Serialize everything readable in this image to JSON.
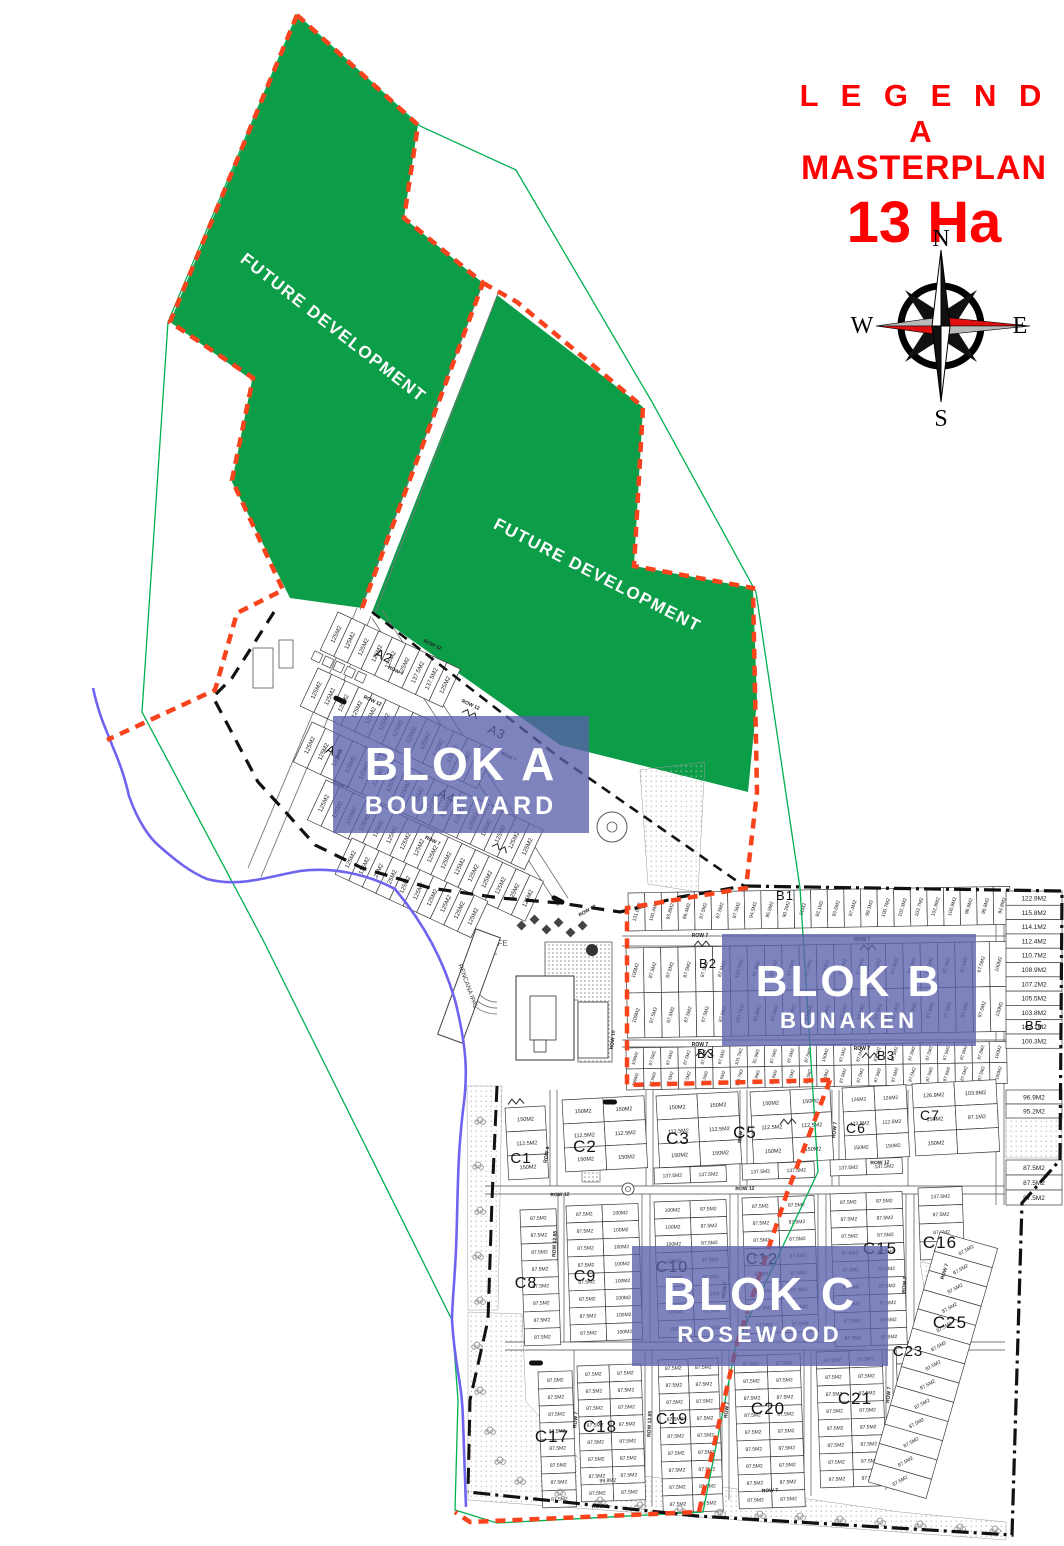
{
  "legend": {
    "line1": "L E G E N D A",
    "line2": "MASTERPLAN",
    "line3": "13 Ha"
  },
  "compass": {
    "north": "N",
    "east": "E",
    "south": "S",
    "west": "W"
  },
  "future": {
    "label": "FUTURE DEVELOPMENT"
  },
  "blocks": [
    {
      "id": "A",
      "title": "BLOK A",
      "subtitle": "BOULEVARD"
    },
    {
      "id": "B",
      "title": "BLOK B",
      "subtitle": "BUNAKEN"
    },
    {
      "id": "C",
      "title": "BLOK C",
      "subtitle": "ROSEWOOD"
    }
  ],
  "poi": {
    "cafe": "CAFE",
    "ipal": "RENCANA IPAL"
  },
  "colors": {
    "accent_red": "#fe0000",
    "green_area": "#0c9d49",
    "green_line": "#00b050",
    "orange_boundary": "#f8431c",
    "purple_overlay": "#5a60ab",
    "river_blue": "#6f63ef"
  },
  "lot_grids": [
    {
      "id": "A2",
      "x": 338,
      "y": 612,
      "rot": 25,
      "cols": 9,
      "rows": 1,
      "cw": 15,
      "ch": 42,
      "fs": 6,
      "lrot": -90,
      "labels_cols": [
        "125M2",
        "125M2",
        "125M2",
        "125M2",
        "125M2",
        "125M2",
        "137.5M2",
        "137.5M2",
        "125M2"
      ]
    },
    {
      "id": "A1a",
      "x": 318,
      "y": 668,
      "rot": 25,
      "cols": 13,
      "rows": 1,
      "cw": 15,
      "ch": 42,
      "fs": 6,
      "lrot": -90,
      "label": "125M2"
    },
    {
      "id": "A1b",
      "x": 312,
      "y": 722,
      "rot": 25,
      "cols": 17,
      "rows": 1,
      "cw": 15,
      "ch": 44,
      "fs": 6,
      "lrot": -90,
      "label": "125M2"
    },
    {
      "id": "A4",
      "x": 326,
      "y": 780,
      "rot": 25,
      "cols": 16,
      "rows": 1,
      "cw": 15,
      "ch": 44,
      "fs": 6,
      "lrot": -90,
      "label": "125M2"
    },
    {
      "id": "A5",
      "x": 352,
      "y": 838,
      "rot": 25,
      "cols": 10,
      "rows": 1,
      "cw": 15,
      "ch": 40,
      "fs": 6,
      "lrot": -90,
      "label": "125M2"
    },
    {
      "id": "B1",
      "x": 628,
      "y": 893,
      "rot": -1,
      "cols": 23,
      "rows": 1,
      "cw": 16.6,
      "ch": 38,
      "fs": 5,
      "lrot": -72,
      "labels_cols": [
        "131.6M2",
        "100.4M2",
        "93.8M2",
        "89.4M2",
        "87.5M2",
        "87.5M2",
        "87.5M2",
        "94.5M2",
        "95.5M2",
        "90.2M2",
        "92M2",
        "93.1M2",
        "93.6M2",
        "97.4M2",
        "99.1M2",
        "100.7M2",
        "102.3M2",
        "103.7M2",
        "102.8M2",
        "100.8M2",
        "98.8M2",
        "96.8M2",
        "94.8M2"
      ]
    },
    {
      "id": "B2",
      "x": 626,
      "y": 948,
      "rot": -1,
      "cols": 22,
      "rows": 2,
      "cw": 17.3,
      "ch": 45,
      "fs": 5,
      "lrot": -72,
      "labels_cols": [
        "100M2",
        "87.5M2",
        "87.5M2",
        "87.5M2",
        "87.5M2",
        "87.5M2",
        "103.7M2",
        "92.9M2",
        "87.5M2",
        "87.5M2",
        "87.5M2",
        "100M2",
        "87.5M2",
        "87.5M2",
        "87.5M2",
        "87.5M2",
        "87.5M2",
        "87.5M2",
        "87.5M2",
        "87.5M2",
        "87.5M2",
        "100M2"
      ]
    },
    {
      "id": "B3",
      "x": 626,
      "y": 1048,
      "rot": -1,
      "cols": 22,
      "rows": 2,
      "cw": 17.3,
      "ch": 21,
      "fs": 4.5,
      "lrot": -72,
      "labels_cols": [
        "100M2",
        "87.5M2",
        "87.5M2",
        "87.5M2",
        "87.5M2",
        "87.5M2",
        "103.7M2",
        "92.9M2",
        "87.5M2",
        "87.5M2",
        "87.5M2",
        "100M2",
        "87.5M2",
        "87.5M2",
        "87.5M2",
        "87.5M2",
        "87.5M2",
        "87.5M2",
        "87.5M2",
        "87.5M2",
        "87.5M2",
        "100M2"
      ]
    },
    {
      "id": "B-right",
      "x": 1006,
      "y": 891,
      "rot": 0,
      "cols": 1,
      "rows": 11,
      "cw": 56,
      "ch": 14.3,
      "fs": 6.5,
      "labels_rows": [
        "122.9M2",
        "115.8M2",
        "114.1M2",
        "112.4M2",
        "110.7M2",
        "108.9M2",
        "107.2M2",
        "105.5M2",
        "103.8M2",
        "102.1M2",
        "100.3M2"
      ]
    },
    {
      "id": "B-right2",
      "x": 1006,
      "y": 1090,
      "rot": 0,
      "cols": 1,
      "rows": 2,
      "cw": 56,
      "ch": 14,
      "fs": 6.5,
      "labels_rows": [
        "96.9M2",
        "95.2M2"
      ]
    },
    {
      "id": "B-right3",
      "x": 1006,
      "y": 1160,
      "rot": 0,
      "cols": 1,
      "rows": 3,
      "cw": 56,
      "ch": 15,
      "fs": 6.5,
      "label": "87.5M2"
    },
    {
      "id": "C1",
      "x": 505,
      "y": 1108,
      "rot": -3,
      "cols": 1,
      "rows": 3,
      "cw": 40,
      "ch": 24,
      "fs": 5.5,
      "labels_rows": [
        "150M2",
        "112.5M2",
        "150M2"
      ]
    },
    {
      "id": "C2",
      "x": 562,
      "y": 1100,
      "rot": -3,
      "cols": 2,
      "rows": 3,
      "cw": 41,
      "ch": 24,
      "fs": 5.5,
      "labels_rows": [
        "150M2",
        "112.5M2",
        "150M2"
      ]
    },
    {
      "id": "C3",
      "x": 656,
      "y": 1096,
      "rot": -3,
      "cols": 2,
      "rows": 3,
      "cw": 41,
      "ch": 24,
      "fs": 5.5,
      "labels_rows": [
        "150M2",
        "112.5M2",
        "150M2"
      ]
    },
    {
      "id": "C5",
      "x": 750,
      "y": 1092,
      "rot": -3,
      "cols": 2,
      "rows": 3,
      "cw": 40,
      "ch": 24,
      "fs": 5.5,
      "labels_rows": [
        "150M2",
        "112.5M2",
        "150M2"
      ]
    },
    {
      "id": "C6",
      "x": 842,
      "y": 1088,
      "rot": -3,
      "cols": 2,
      "rows": 3,
      "cw": 32,
      "ch": 24,
      "fs": 5,
      "labels_rows": [
        "126M2",
        "112.5M2",
        "150M2"
      ]
    },
    {
      "id": "C7",
      "x": 912,
      "y": 1084,
      "rot": -3,
      "cols": 2,
      "rows": 3,
      "cw": 42,
      "ch": 24,
      "fs": 5.5,
      "labels_grid": [
        [
          "126.9M2",
          "103.9M2"
        ],
        [
          "150M2",
          "97.1M2"
        ],
        [
          "150M2",
          ""
        ]
      ]
    },
    {
      "id": "C8",
      "x": 520,
      "y": 1210,
      "rot": -2,
      "cols": 1,
      "rows": 8,
      "cw": 36,
      "ch": 17,
      "fs": 5,
      "label": "87.5M2"
    },
    {
      "id": "C9",
      "x": 566,
      "y": 1206,
      "rot": -2,
      "cols": 2,
      "rows": 8,
      "cw": 36,
      "ch": 17,
      "fs": 5,
      "labels_cols": [
        "87.5M2",
        "100M2"
      ]
    },
    {
      "id": "C10t",
      "x": 654,
      "y": 1168,
      "rot": -2,
      "cols": 2,
      "rows": 1,
      "cw": 36,
      "ch": 16,
      "fs": 5,
      "label": "137.5M2"
    },
    {
      "id": "C10",
      "x": 654,
      "y": 1202,
      "rot": -2,
      "cols": 2,
      "rows": 8,
      "cw": 36,
      "ch": 17,
      "fs": 5,
      "labels_cols": [
        "100M2",
        "87.5M2"
      ]
    },
    {
      "id": "C12t",
      "x": 742,
      "y": 1164,
      "rot": -2,
      "cols": 2,
      "rows": 1,
      "cw": 36,
      "ch": 16,
      "fs": 5,
      "label": "137.5M2"
    },
    {
      "id": "C12",
      "x": 742,
      "y": 1198,
      "rot": -2,
      "cols": 2,
      "rows": 8,
      "cw": 36,
      "ch": 17,
      "fs": 5,
      "label": "87.5M2"
    },
    {
      "id": "C15t",
      "x": 830,
      "y": 1160,
      "rot": -2,
      "cols": 2,
      "rows": 1,
      "cw": 36,
      "ch": 16,
      "fs": 5,
      "label": "137.5M2"
    },
    {
      "id": "C15",
      "x": 830,
      "y": 1194,
      "rot": -2,
      "cols": 2,
      "rows": 9,
      "cw": 36,
      "ch": 17,
      "fs": 5,
      "label": "87.5M2"
    },
    {
      "id": "C16",
      "x": 918,
      "y": 1188,
      "rot": -2,
      "cols": 1,
      "rows": 4,
      "cw": 44,
      "ch": 18,
      "fs": 5,
      "labels_rows": [
        "137.5M2",
        "87.5M2",
        "87.5M2",
        "87.5M2"
      ]
    },
    {
      "id": "C17",
      "x": 538,
      "y": 1372,
      "rot": -2,
      "cols": 1,
      "rows": 8,
      "cw": 34,
      "ch": 17,
      "fs": 5,
      "label": "87.5M2"
    },
    {
      "id": "C18",
      "x": 577,
      "y": 1366,
      "rot": -2,
      "cols": 2,
      "rows": 8,
      "cw": 32,
      "ch": 17,
      "fs": 5,
      "label": "87.5M2"
    },
    {
      "id": "C19",
      "x": 658,
      "y": 1360,
      "rot": -2,
      "cols": 2,
      "rows": 9,
      "cw": 30,
      "ch": 17,
      "fs": 5,
      "label": "87.5M2"
    },
    {
      "id": "C20",
      "x": 734,
      "y": 1356,
      "rot": -2,
      "cols": 2,
      "rows": 9,
      "cw": 33,
      "ch": 17,
      "fs": 5,
      "label": "87.5M2"
    },
    {
      "id": "C21",
      "x": 816,
      "y": 1352,
      "rot": -2,
      "cols": 2,
      "rows": 8,
      "cw": 33,
      "ch": 17,
      "fs": 5,
      "label": "87.5M2"
    },
    {
      "id": "C23",
      "x": 896,
      "y": 1348,
      "rot": -2,
      "cols": 1,
      "rows": 4,
      "cw": 34,
      "ch": 16,
      "fs": 5,
      "label": "87.5M2"
    },
    {
      "id": "C25",
      "x": 940,
      "y": 1232,
      "rot": 16,
      "cols": 1,
      "rows": 13,
      "cw": 60,
      "ch": 20,
      "fs": 5,
      "lrot": -45,
      "label": "87.5M2"
    }
  ],
  "section_labels": [
    {
      "t": "A1",
      "x": 333,
      "y": 756,
      "rot": 25,
      "fs": 13
    },
    {
      "t": "A2",
      "x": 382,
      "y": 660,
      "rot": 25,
      "fs": 13
    },
    {
      "t": "A3",
      "x": 495,
      "y": 736,
      "rot": 25,
      "fs": 13
    },
    {
      "t": "A4",
      "x": 445,
      "y": 800,
      "rot": 25,
      "fs": 13
    },
    {
      "t": "B1",
      "x": 785,
      "y": 900,
      "rot": 0,
      "fs": 13
    },
    {
      "t": "B2",
      "x": 708,
      "y": 968,
      "rot": 0,
      "fs": 13
    },
    {
      "t": "B3",
      "x": 706,
      "y": 1058,
      "rot": 0,
      "fs": 13
    },
    {
      "t": "B3",
      "x": 886,
      "y": 1060,
      "rot": 0,
      "fs": 13
    },
    {
      "t": "B5",
      "x": 1034,
      "y": 1030,
      "rot": 0,
      "fs": 13
    },
    {
      "t": "C1",
      "x": 521,
      "y": 1163,
      "rot": 0,
      "fs": 15
    },
    {
      "t": "C2",
      "x": 585,
      "y": 1152,
      "rot": 0,
      "fs": 17
    },
    {
      "t": "C3",
      "x": 678,
      "y": 1144,
      "rot": 0,
      "fs": 17
    },
    {
      "t": "C5",
      "x": 745,
      "y": 1138,
      "rot": 0,
      "fs": 17
    },
    {
      "t": "C6",
      "x": 856,
      "y": 1133,
      "rot": 0,
      "fs": 14
    },
    {
      "t": "C7",
      "x": 930,
      "y": 1120,
      "rot": 0,
      "fs": 14
    },
    {
      "t": "C8",
      "x": 526,
      "y": 1288,
      "rot": 0,
      "fs": 16
    },
    {
      "t": "C9",
      "x": 585,
      "y": 1281,
      "rot": 0,
      "fs": 16
    },
    {
      "t": "C10",
      "x": 672,
      "y": 1272,
      "rot": 0,
      "fs": 16
    },
    {
      "t": "C12",
      "x": 762,
      "y": 1264,
      "rot": 0,
      "fs": 16
    },
    {
      "t": "C15",
      "x": 880,
      "y": 1254,
      "rot": 0,
      "fs": 17
    },
    {
      "t": "C16",
      "x": 940,
      "y": 1248,
      "rot": 0,
      "fs": 17
    },
    {
      "t": "C17",
      "x": 552,
      "y": 1442,
      "rot": 0,
      "fs": 17
    },
    {
      "t": "C18",
      "x": 600,
      "y": 1432,
      "rot": 0,
      "fs": 17
    },
    {
      "t": "C19",
      "x": 672,
      "y": 1424,
      "rot": 0,
      "fs": 16
    },
    {
      "t": "C20",
      "x": 768,
      "y": 1414,
      "rot": 0,
      "fs": 17
    },
    {
      "t": "C21",
      "x": 855,
      "y": 1404,
      "rot": 0,
      "fs": 17
    },
    {
      "t": "C23",
      "x": 908,
      "y": 1356,
      "rot": 0,
      "fs": 15
    },
    {
      "t": "C25",
      "x": 950,
      "y": 1328,
      "rot": 0,
      "fs": 17
    }
  ],
  "row_labels": [
    {
      "t": "ROW 12",
      "x": 372,
      "y": 702,
      "rot": 25
    },
    {
      "t": "ROW 7",
      "x": 340,
      "y": 786,
      "rot": 25
    },
    {
      "t": "ROW 7",
      "x": 432,
      "y": 842,
      "rot": 25
    },
    {
      "t": "ROW 12",
      "x": 470,
      "y": 706,
      "rot": 25
    },
    {
      "t": "ROW 7",
      "x": 508,
      "y": 758,
      "rot": 25
    },
    {
      "t": "ROW 12",
      "x": 432,
      "y": 646,
      "rot": 25
    },
    {
      "t": "ROW 7",
      "x": 395,
      "y": 672,
      "rot": 25
    },
    {
      "t": "ROW 7",
      "x": 700,
      "y": 937,
      "rot": 0
    },
    {
      "t": "ROW 7",
      "x": 862,
      "y": 941,
      "rot": 0
    },
    {
      "t": "ROW 7",
      "x": 700,
      "y": 1046,
      "rot": 0
    },
    {
      "t": "ROW 7",
      "x": 862,
      "y": 1050,
      "rot": 0
    },
    {
      "t": "ROW 10",
      "x": 614,
      "y": 1040,
      "rot": -85
    },
    {
      "t": "ROW 12",
      "x": 588,
      "y": 912,
      "rot": -30
    },
    {
      "t": "ROW 12",
      "x": 745,
      "y": 1190,
      "rot": -2
    },
    {
      "t": "ROW 12",
      "x": 560,
      "y": 1196,
      "rot": -2
    },
    {
      "t": "ROW 12",
      "x": 880,
      "y": 1164,
      "rot": -2
    },
    {
      "t": "ROW 12.65",
      "x": 556,
      "y": 1244,
      "rot": -88
    },
    {
      "t": "ROW 12.65",
      "x": 651,
      "y": 1424,
      "rot": -88
    },
    {
      "t": "ROW 9",
      "x": 548,
      "y": 1155,
      "rot": -80
    },
    {
      "t": "ROW 7",
      "x": 742,
      "y": 1135,
      "rot": -85
    },
    {
      "t": "ROW 7",
      "x": 836,
      "y": 1130,
      "rot": -85
    },
    {
      "t": "ROW 7",
      "x": 726,
      "y": 1290,
      "rot": -85
    },
    {
      "t": "ROW 7",
      "x": 906,
      "y": 1285,
      "rot": -85
    },
    {
      "t": "ROW 7",
      "x": 577,
      "y": 1420,
      "rot": -85
    },
    {
      "t": "ROW 7",
      "x": 728,
      "y": 1410,
      "rot": -85
    },
    {
      "t": "ROW 7",
      "x": 890,
      "y": 1395,
      "rot": -85
    },
    {
      "t": "ROW 7",
      "x": 600,
      "y": 1508,
      "rot": -2
    },
    {
      "t": "ROW 7",
      "x": 770,
      "y": 1492,
      "rot": -3
    },
    {
      "t": "ROW 7",
      "x": 946,
      "y": 1272,
      "rot": -72
    }
  ],
  "extra_labels": [
    {
      "t": "99.8M2",
      "x": 608,
      "y": 1482,
      "rot": -3,
      "fs": 5
    }
  ],
  "zigzags": [
    {
      "x": 470,
      "y": 714,
      "rot": 25
    },
    {
      "x": 500,
      "y": 848,
      "rot": 25
    },
    {
      "x": 702,
      "y": 944,
      "rot": 0
    },
    {
      "x": 868,
      "y": 948,
      "rot": 0
    },
    {
      "x": 704,
      "y": 1054,
      "rot": 0
    },
    {
      "x": 870,
      "y": 1056,
      "rot": 0
    },
    {
      "x": 516,
      "y": 1102,
      "rot": -3
    },
    {
      "x": 788,
      "y": 1122,
      "rot": -3
    }
  ],
  "markers": [
    {
      "x": 340,
      "y": 700,
      "rot": 25
    },
    {
      "x": 610,
      "y": 1102,
      "rot": 0
    },
    {
      "x": 536,
      "y": 1363,
      "rot": 0
    },
    {
      "x": 558,
      "y": 900,
      "rot": 28
    }
  ],
  "trees": [
    {
      "x": 480,
      "y": 1120
    },
    {
      "x": 478,
      "y": 1165
    },
    {
      "x": 480,
      "y": 1210
    },
    {
      "x": 478,
      "y": 1255
    },
    {
      "x": 480,
      "y": 1300
    },
    {
      "x": 477,
      "y": 1345
    },
    {
      "x": 480,
      "y": 1390
    },
    {
      "x": 490,
      "y": 1430
    },
    {
      "x": 500,
      "y": 1460
    },
    {
      "x": 520,
      "y": 1480
    },
    {
      "x": 560,
      "y": 1492
    },
    {
      "x": 600,
      "y": 1500
    },
    {
      "x": 640,
      "y": 1505
    },
    {
      "x": 680,
      "y": 1509
    },
    {
      "x": 720,
      "y": 1512
    },
    {
      "x": 760,
      "y": 1514
    },
    {
      "x": 800,
      "y": 1516
    },
    {
      "x": 840,
      "y": 1519
    },
    {
      "x": 880,
      "y": 1521
    },
    {
      "x": 920,
      "y": 1524
    },
    {
      "x": 960,
      "y": 1527
    },
    {
      "x": 995,
      "y": 1529
    }
  ]
}
